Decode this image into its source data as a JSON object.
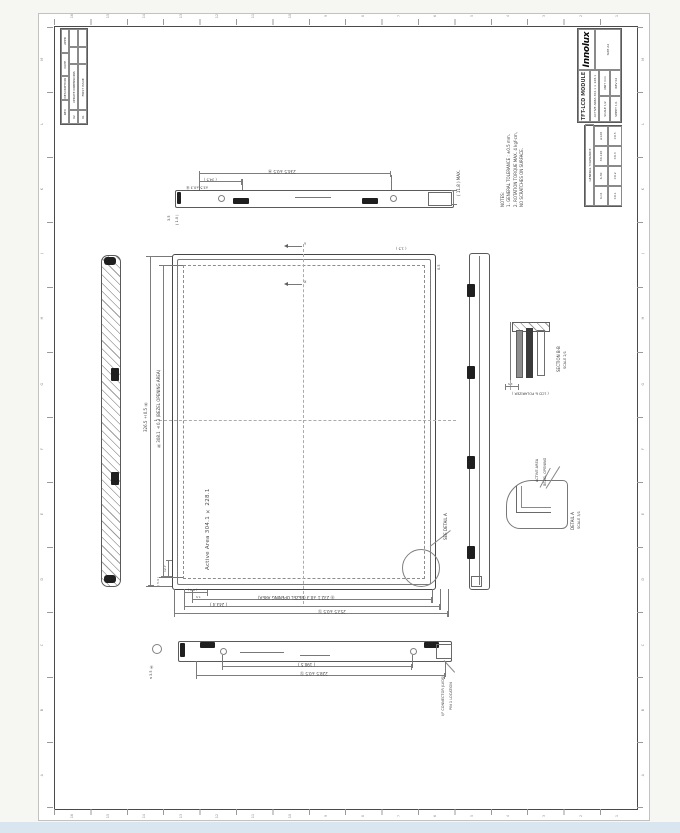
{
  "colors": {
    "background": "#f6f6f3",
    "sheet": "#ffffff",
    "frame": "#4a4a4a",
    "line": "#777777",
    "dark": "#1f1f1f",
    "footer_bar": "#d9e6f0"
  },
  "zones": {
    "numbers": [
      "16",
      "15",
      "14",
      "13",
      "12",
      "11",
      "10",
      "9",
      "8",
      "7",
      "6",
      "5",
      "4",
      "3",
      "2",
      "1"
    ],
    "letters": [
      "M",
      "L",
      "K",
      "J",
      "H",
      "G",
      "F",
      "E",
      "D",
      "C",
      "B",
      "A"
    ]
  },
  "revision_table": {
    "headers": [
      "REV",
      "DESCRIPTION",
      "DATE",
      "APPD"
    ],
    "rows": [
      [
        "02",
        "UPDATE DIMENSIONS",
        "",
        ""
      ],
      [
        "01",
        "FIRST ISSUE",
        "",
        ""
      ]
    ]
  },
  "title_block": {
    "logo": "Innolux",
    "size": "SIZE A2",
    "title": "TFT-LCD MODULE",
    "subtitle": "ACTIVE AREA 304.1 × 228.1",
    "meta": [
      "SCALE 1/2",
      "UNIT mm",
      "SHEET 1/1",
      "REV 02"
    ]
  },
  "tolerance_table": {
    "title": "GENERAL TOLERANCE",
    "ranges": [
      "X<6",
      "6-30",
      "30-120",
      "≥120"
    ],
    "values": [
      "±0.1",
      "±0.2",
      "±0.3",
      "±0.5"
    ]
  },
  "notes": {
    "lines": [
      "NOTES:",
      "1. GENERAL TOLERANCE : ±0.5 mm.",
      "2. ROTATION TORQUE MAX. 4 kgf-cm,",
      "    NO SCRATCHES ON SURFACE."
    ]
  },
  "front_view": {
    "active_area": "Active Area 304.1 × 228.1",
    "see_detail": "SEE DETAIL A",
    "datum_v": "Y",
    "datum_h": "X",
    "dim_corner": "( 1.5 )",
    "dim_edge": "0.5"
  },
  "dims": {
    "bottom_bezel": "Ⓑ 232.1 ±0.3 (BEZEL OPENING AREA)",
    "bottom_mid": "( 243.4 )",
    "bottom_outer": "253.5 ±0.5 Ⓢ",
    "bottom_s1": "7.5",
    "bottom_s2": "( 9.0 )",
    "left_outer": "326.5 ±0.5 Ⓜ",
    "left_bezel": "Ⓑ 308.1 ±0.3 (BEZEL OPENING AREA)",
    "left_s1": "12.7",
    "left_s2": "( 5.4 )"
  },
  "top_view": {
    "dim_long": "234.5 ±0.5 Ⓜ",
    "dim_short": "( 34.5 )",
    "thickness": "( 11.8 ) MAX.",
    "hole_callout": "⌀3.5 ±0.3 Ⓑ",
    "dim_s1": "3.5",
    "dim_s2": "( 1.0 )"
  },
  "bottom_view": {
    "dim_long": "228.5 ±0.5 Ⓢ",
    "dim_mid": "( 190.5 )",
    "hole_callout": "⌀3.5 Ⓑ",
    "leader_line1": "I/F CONNECTOR (LVDS)",
    "leader_line2": "PIN 1 LOCATION"
  },
  "section_view": {
    "name": "SECTION B-B",
    "scale": "SCALE 2/1",
    "note": "( LCD & POLARIZER )",
    "dim": "1.5"
  },
  "detail_view": {
    "name": "DETAIL A",
    "scale": "SCALE 3/1",
    "label1": "ACTIVE AREA",
    "label2": "BEZEL OPENING"
  }
}
